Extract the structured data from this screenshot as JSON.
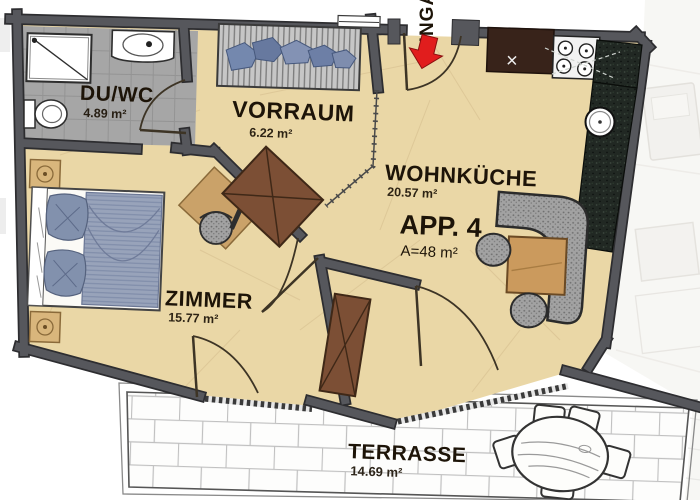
{
  "title": "Apartment floor plan",
  "apartment": {
    "id_label": "APP. 4",
    "area_label": "A=48 m²",
    "area_m2": 48
  },
  "entrance": {
    "label": "EINGANG"
  },
  "rooms": [
    {
      "id": "duwc",
      "name": "DU/WC",
      "area_m2": 4.89,
      "area_label": "4.89 m²"
    },
    {
      "id": "vorraum",
      "name": "VORRAUM",
      "area_m2": 6.22,
      "area_label": "6.22 m²"
    },
    {
      "id": "wohnkueche",
      "name": "WOHNKÜCHE",
      "area_m2": 20.57,
      "area_label": "20.57 m²"
    },
    {
      "id": "zimmer",
      "name": "ZIMMER",
      "area_m2": 15.77,
      "area_label": "15.77 m²"
    },
    {
      "id": "terrasse",
      "name": "TERRASSE",
      "area_m2": 14.69,
      "area_label": "14.69 m²"
    }
  ],
  "colors": {
    "wall": "#56575c",
    "wall_edge": "#2d2d30",
    "floor": "#ead7a6",
    "bath_tile": "#a6a6a6",
    "counter": "#212823",
    "entrance_arrow": "#e11d1d",
    "terrace_paving": "#fdfdfc",
    "bed_textile": "#98a3ba"
  }
}
